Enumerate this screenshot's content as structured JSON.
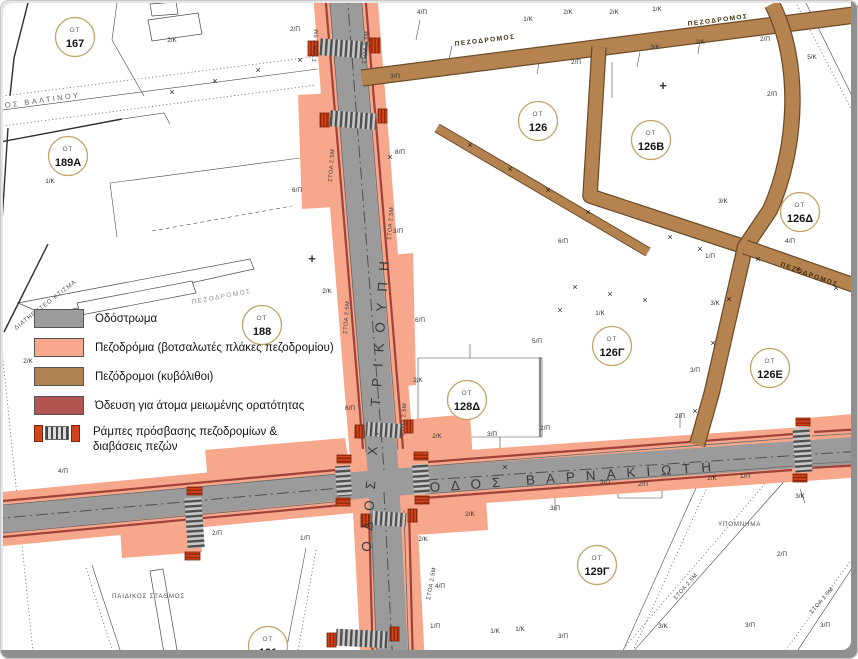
{
  "streets": {
    "vertical": "ΟΔΟΣ Χ. ΤΡΙΚΟΥΠΗ",
    "horizontal": "ΟΔΟΣ ΒΑΡΝΑΚΙΩΤΗ",
    "top_left": "ΟΔΟΣ ΒΑΛΤΙΝΟΥ"
  },
  "legend": {
    "title": "ΥΠΟΜΝΗΜΑ",
    "items": [
      {
        "label": "Οδόστρωμα",
        "color": "#9c9c9c"
      },
      {
        "label": "Πεζοδρόμια (βοτσαλωτές πλάκες πεζοδρομίου)",
        "color": "#f8a88c"
      },
      {
        "label": "Πεζόδρομοι (κυβόλιθοι)",
        "color": "#b08152"
      },
      {
        "label": "Όδευση για άτομα μειωμένης ορατότητας",
        "color": "#b25551"
      },
      {
        "label": "Ράμπες πρόσβασης πεζοδρομίων &",
        "label2": "διαβάσεις πεζών"
      }
    ]
  },
  "ot_label": "ΟΤ",
  "blocks": [
    {
      "number": "167",
      "x": 75,
      "y": 37
    },
    {
      "number": "189Α",
      "x": 68,
      "y": 156
    },
    {
      "number": "188",
      "x": 262,
      "y": 325
    },
    {
      "number": "126",
      "x": 538,
      "y": 121
    },
    {
      "number": "126Β",
      "x": 651,
      "y": 140
    },
    {
      "number": "126Δ",
      "x": 800,
      "y": 212
    },
    {
      "number": "126Γ",
      "x": 612,
      "y": 346
    },
    {
      "number": "126Ε",
      "x": 770,
      "y": 368
    },
    {
      "number": "128Δ",
      "x": 467,
      "y": 400
    },
    {
      "number": "129Γ",
      "x": 597,
      "y": 565
    },
    {
      "number": "191",
      "x": 268,
      "y": 646
    }
  ],
  "pezodromos_labels": [
    {
      "text": "ΠΕΖΟΔΡΟΜΟΣ",
      "x": 455,
      "y": 46,
      "rot": -7,
      "muted": false
    },
    {
      "text": "ΠΕΖΟΔΡΟΜΟΣ",
      "x": 688,
      "y": 26,
      "rot": -7.5,
      "muted": false
    },
    {
      "text": "ΠΕΖΟΔΡΟΜΟΣ",
      "x": 780,
      "y": 266,
      "rot": 20,
      "muted": false
    },
    {
      "text": "ΠΕΖΟΔΡΟΜΟΣ",
      "x": 192,
      "y": 304,
      "rot": -10.5,
      "muted": true
    }
  ],
  "stoa_labels": [
    {
      "text": "ΣΤΟΑ 2.5Μ",
      "x": 316,
      "y": 62,
      "rot": -86
    },
    {
      "text": "ΣΤΟΑ 2.5Μ",
      "x": 366,
      "y": 64,
      "rot": -86
    },
    {
      "text": "ΣΤΟΑ 2.5Μ",
      "x": 332,
      "y": 182,
      "rot": -86
    },
    {
      "text": "ΣΤΟΑ 2.5Μ",
      "x": 347,
      "y": 334,
      "rot": -86
    },
    {
      "text": "ΣΤΟΑ 2.5Μ",
      "x": 391,
      "y": 240,
      "rot": -86
    },
    {
      "text": "ΣΤΟΑ 2.5Μ",
      "x": 404,
      "y": 436,
      "rot": -86
    },
    {
      "text": "ΣΤΟΑ 2.5Μ",
      "x": 430,
      "y": 600,
      "rot": -80
    },
    {
      "text": "ΣΤΟΑ 2.5Μ",
      "x": 676,
      "y": 600,
      "rot": -49
    },
    {
      "text": "ΣΤΟΑ 2.5Μ",
      "x": 812,
      "y": 614,
      "rot": -49
    }
  ],
  "parcel_labels": [
    {
      "t": "2/Κ",
      "x": 172,
      "y": 42
    },
    {
      "t": "1/Κ",
      "x": 50,
      "y": 183
    },
    {
      "t": "2/Κ",
      "x": 28,
      "y": 363
    },
    {
      "t": "2/Π",
      "x": 295,
      "y": 31
    },
    {
      "t": "4/Π",
      "x": 422,
      "y": 14
    },
    {
      "t": "1/Κ",
      "x": 528,
      "y": 21
    },
    {
      "t": "2/Κ",
      "x": 568,
      "y": 14
    },
    {
      "t": "2/Κ",
      "x": 614,
      "y": 14
    },
    {
      "t": "1/Κ",
      "x": 657,
      "y": 11
    },
    {
      "t": "3/Π",
      "x": 395,
      "y": 78
    },
    {
      "t": "8/Π",
      "x": 400,
      "y": 154
    },
    {
      "t": "3/Κ",
      "x": 655,
      "y": 49
    },
    {
      "t": "2/Κ",
      "x": 700,
      "y": 44
    },
    {
      "t": "2/Π",
      "x": 765,
      "y": 41
    },
    {
      "t": "2/Π",
      "x": 576,
      "y": 64
    },
    {
      "t": "5/Κ",
      "x": 812,
      "y": 59
    },
    {
      "t": "2/Π",
      "x": 772,
      "y": 96
    },
    {
      "t": "3/Κ",
      "x": 723,
      "y": 203
    },
    {
      "t": "4/Π",
      "x": 790,
      "y": 243
    },
    {
      "t": "1/Π",
      "x": 710,
      "y": 258
    },
    {
      "t": "3/Κ",
      "x": 715,
      "y": 305
    },
    {
      "t": "1/Κ",
      "x": 600,
      "y": 315
    },
    {
      "t": "3/Π",
      "x": 695,
      "y": 372
    },
    {
      "t": "6/Π",
      "x": 563,
      "y": 243
    },
    {
      "t": "6/Π",
      "x": 297,
      "y": 192
    },
    {
      "t": "2/Κ",
      "x": 327,
      "y": 293
    },
    {
      "t": "3/Π",
      "x": 398,
      "y": 233
    },
    {
      "t": "6/Π",
      "x": 420,
      "y": 322
    },
    {
      "t": "5/Π",
      "x": 537,
      "y": 343
    },
    {
      "t": "2/Κ",
      "x": 418,
      "y": 382
    },
    {
      "t": "2/Κ",
      "x": 437,
      "y": 438
    },
    {
      "t": "3/Π",
      "x": 492,
      "y": 436
    },
    {
      "t": "2/Π",
      "x": 545,
      "y": 430
    },
    {
      "t": "6/Π",
      "x": 350,
      "y": 410
    },
    {
      "t": "2/Κ",
      "x": 470,
      "y": 516
    },
    {
      "t": "3/Π",
      "x": 555,
      "y": 510
    },
    {
      "t": "2/Π",
      "x": 680,
      "y": 418
    },
    {
      "t": "2/Π",
      "x": 643,
      "y": 486
    },
    {
      "t": "3/Π",
      "x": 605,
      "y": 484
    },
    {
      "t": "2/Κ",
      "x": 712,
      "y": 480
    },
    {
      "t": "1/Π",
      "x": 745,
      "y": 478
    },
    {
      "t": "3/Κ",
      "x": 800,
      "y": 498
    },
    {
      "t": "2/Π",
      "x": 782,
      "y": 556
    },
    {
      "t": "3/Π",
      "x": 750,
      "y": 627
    },
    {
      "t": "3/Κ",
      "x": 663,
      "y": 628
    },
    {
      "t": "3/Π",
      "x": 825,
      "y": 627
    },
    {
      "t": "1/Κ",
      "x": 495,
      "y": 633
    },
    {
      "t": "1/Κ",
      "x": 520,
      "y": 631
    },
    {
      "t": "3/Π",
      "x": 563,
      "y": 638
    },
    {
      "t": "4/Π",
      "x": 440,
      "y": 588
    },
    {
      "t": "2/Κ",
      "x": 423,
      "y": 541
    },
    {
      "t": "1/Π",
      "x": 435,
      "y": 628
    },
    {
      "t": "4/Π",
      "x": 63,
      "y": 473
    },
    {
      "t": "2/Π",
      "x": 217,
      "y": 535
    },
    {
      "t": "1/Π",
      "x": 305,
      "y": 540
    }
  ],
  "notes": [
    {
      "text": "ΔΙΑΤΗΡΗΤΕΟ ΚΤΙΣΜΑ",
      "x": 16,
      "y": 330,
      "rot": -38
    },
    {
      "text": "ΠΑΙΔΙΚΟΣ ΣΤΑΘΜΟΣ",
      "x": 112,
      "y": 598,
      "rot": 0
    },
    {
      "text": "ΥΠΟΜΝΗΜΑ",
      "x": 718,
      "y": 526,
      "rot": 0
    }
  ],
  "symbols": {
    "cross": "×",
    "cross_positions": [
      [
        172,
        95
      ],
      [
        215,
        84
      ],
      [
        258,
        73
      ],
      [
        300,
        63
      ],
      [
        470,
        148
      ],
      [
        510,
        172
      ],
      [
        548,
        193
      ],
      [
        588,
        215
      ],
      [
        700,
        252
      ],
      [
        758,
        262
      ],
      [
        798,
        272
      ],
      [
        729,
        302
      ],
      [
        713,
        346
      ],
      [
        695,
        414
      ],
      [
        836,
        291
      ],
      [
        575,
        290
      ],
      [
        610,
        297
      ],
      [
        645,
        303
      ],
      [
        505,
        470
      ],
      [
        560,
        313
      ],
      [
        390,
        160
      ],
      [
        670,
        240
      ]
    ],
    "plus": "+",
    "plus_positions": [
      [
        663,
        90
      ],
      [
        312,
        263
      ]
    ]
  }
}
